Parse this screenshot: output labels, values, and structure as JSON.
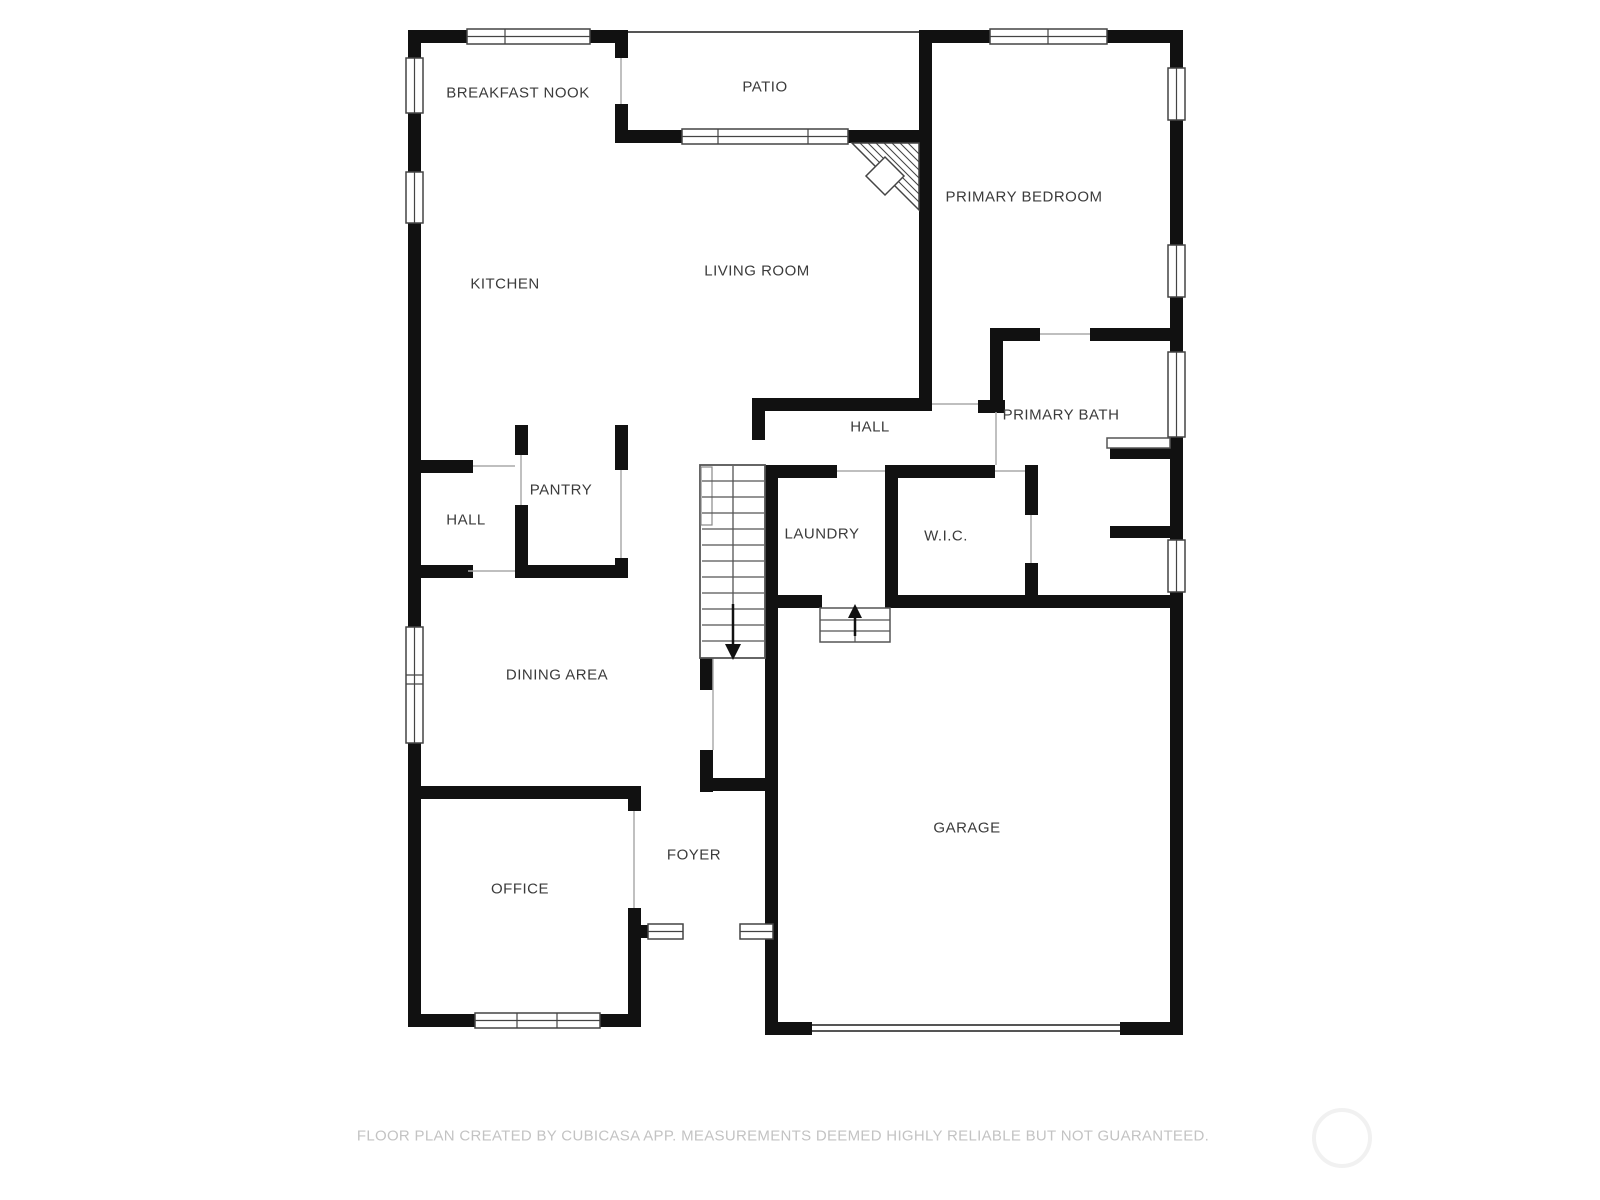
{
  "floor_plan": {
    "rooms": [
      {
        "id": "breakfast-nook",
        "label": "BREAKFAST NOOK"
      },
      {
        "id": "patio",
        "label": "PATIO"
      },
      {
        "id": "primary-bedroom",
        "label": "PRIMARY BEDROOM"
      },
      {
        "id": "kitchen",
        "label": "KITCHEN"
      },
      {
        "id": "living-room",
        "label": "LIVING ROOM"
      },
      {
        "id": "hall-center",
        "label": "HALL"
      },
      {
        "id": "primary-bath",
        "label": "PRIMARY BATH"
      },
      {
        "id": "pantry",
        "label": "PANTRY"
      },
      {
        "id": "hall-left",
        "label": "HALL"
      },
      {
        "id": "laundry",
        "label": "LAUNDRY"
      },
      {
        "id": "wic",
        "label": "W.I.C."
      },
      {
        "id": "dining-area",
        "label": "DINING AREA"
      },
      {
        "id": "foyer",
        "label": "FOYER"
      },
      {
        "id": "office",
        "label": "OFFICE"
      },
      {
        "id": "garage",
        "label": "GARAGE"
      }
    ],
    "colors": {
      "wall": "#111111",
      "thin_line": "#555555",
      "window_stroke": "#444444",
      "label_text": "#3b3b3b",
      "footer_text": "#c3c3c3",
      "background": "#ffffff"
    }
  },
  "footer": {
    "disclaimer": "FLOOR PLAN CREATED BY CUBICASA APP. MEASUREMENTS DEEMED HIGHLY RELIABLE BUT NOT GUARANTEED."
  }
}
